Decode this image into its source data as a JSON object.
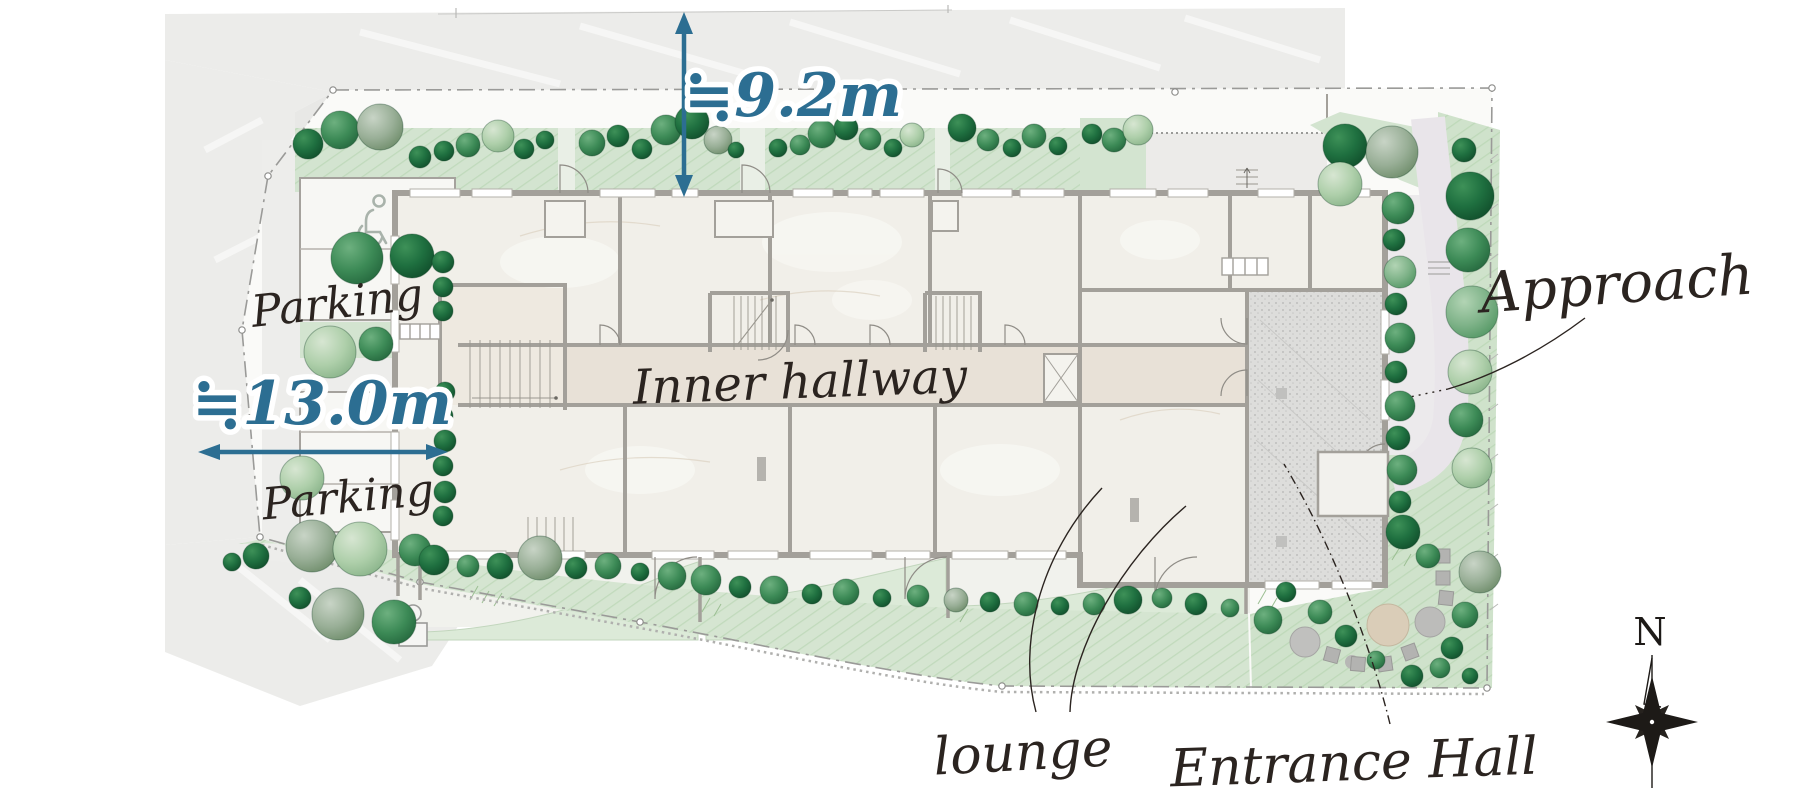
{
  "figure": {
    "dimensions": {
      "site_depth_label": "≒9.2m",
      "site_width_label": "≒13.0m"
    },
    "labels": {
      "parking_upper": "Parking",
      "parking_lower": "Parking",
      "inner_hallway": "Inner hallway",
      "approach": "Approach",
      "lounge": "lounge",
      "entrance_hall": "Entrance Hall"
    },
    "compass": {
      "north": "N"
    },
    "icons": {
      "accessible_parking": "wheelchair-icon",
      "compass_rose": "compass-rose-icon",
      "garden_figure": "garden-figure-icon"
    },
    "colors": {
      "dimension_blue": "#2C6E92",
      "label_ink": "#2B2420",
      "green_area": "#D3E4D0",
      "tree_dark": "#1F7040",
      "tree_mid": "#3C8A56",
      "tree_light": "#7FB389",
      "tree_pale": "#AECFAA",
      "tree_gray": "#99AF97",
      "road_gray": "#ECECEA",
      "building_floor": "#F1EFE9",
      "hallway_floor": "#E8E1D7",
      "entrance_floor": "#DDDDDB",
      "wall_gray": "#A3A09A"
    }
  }
}
